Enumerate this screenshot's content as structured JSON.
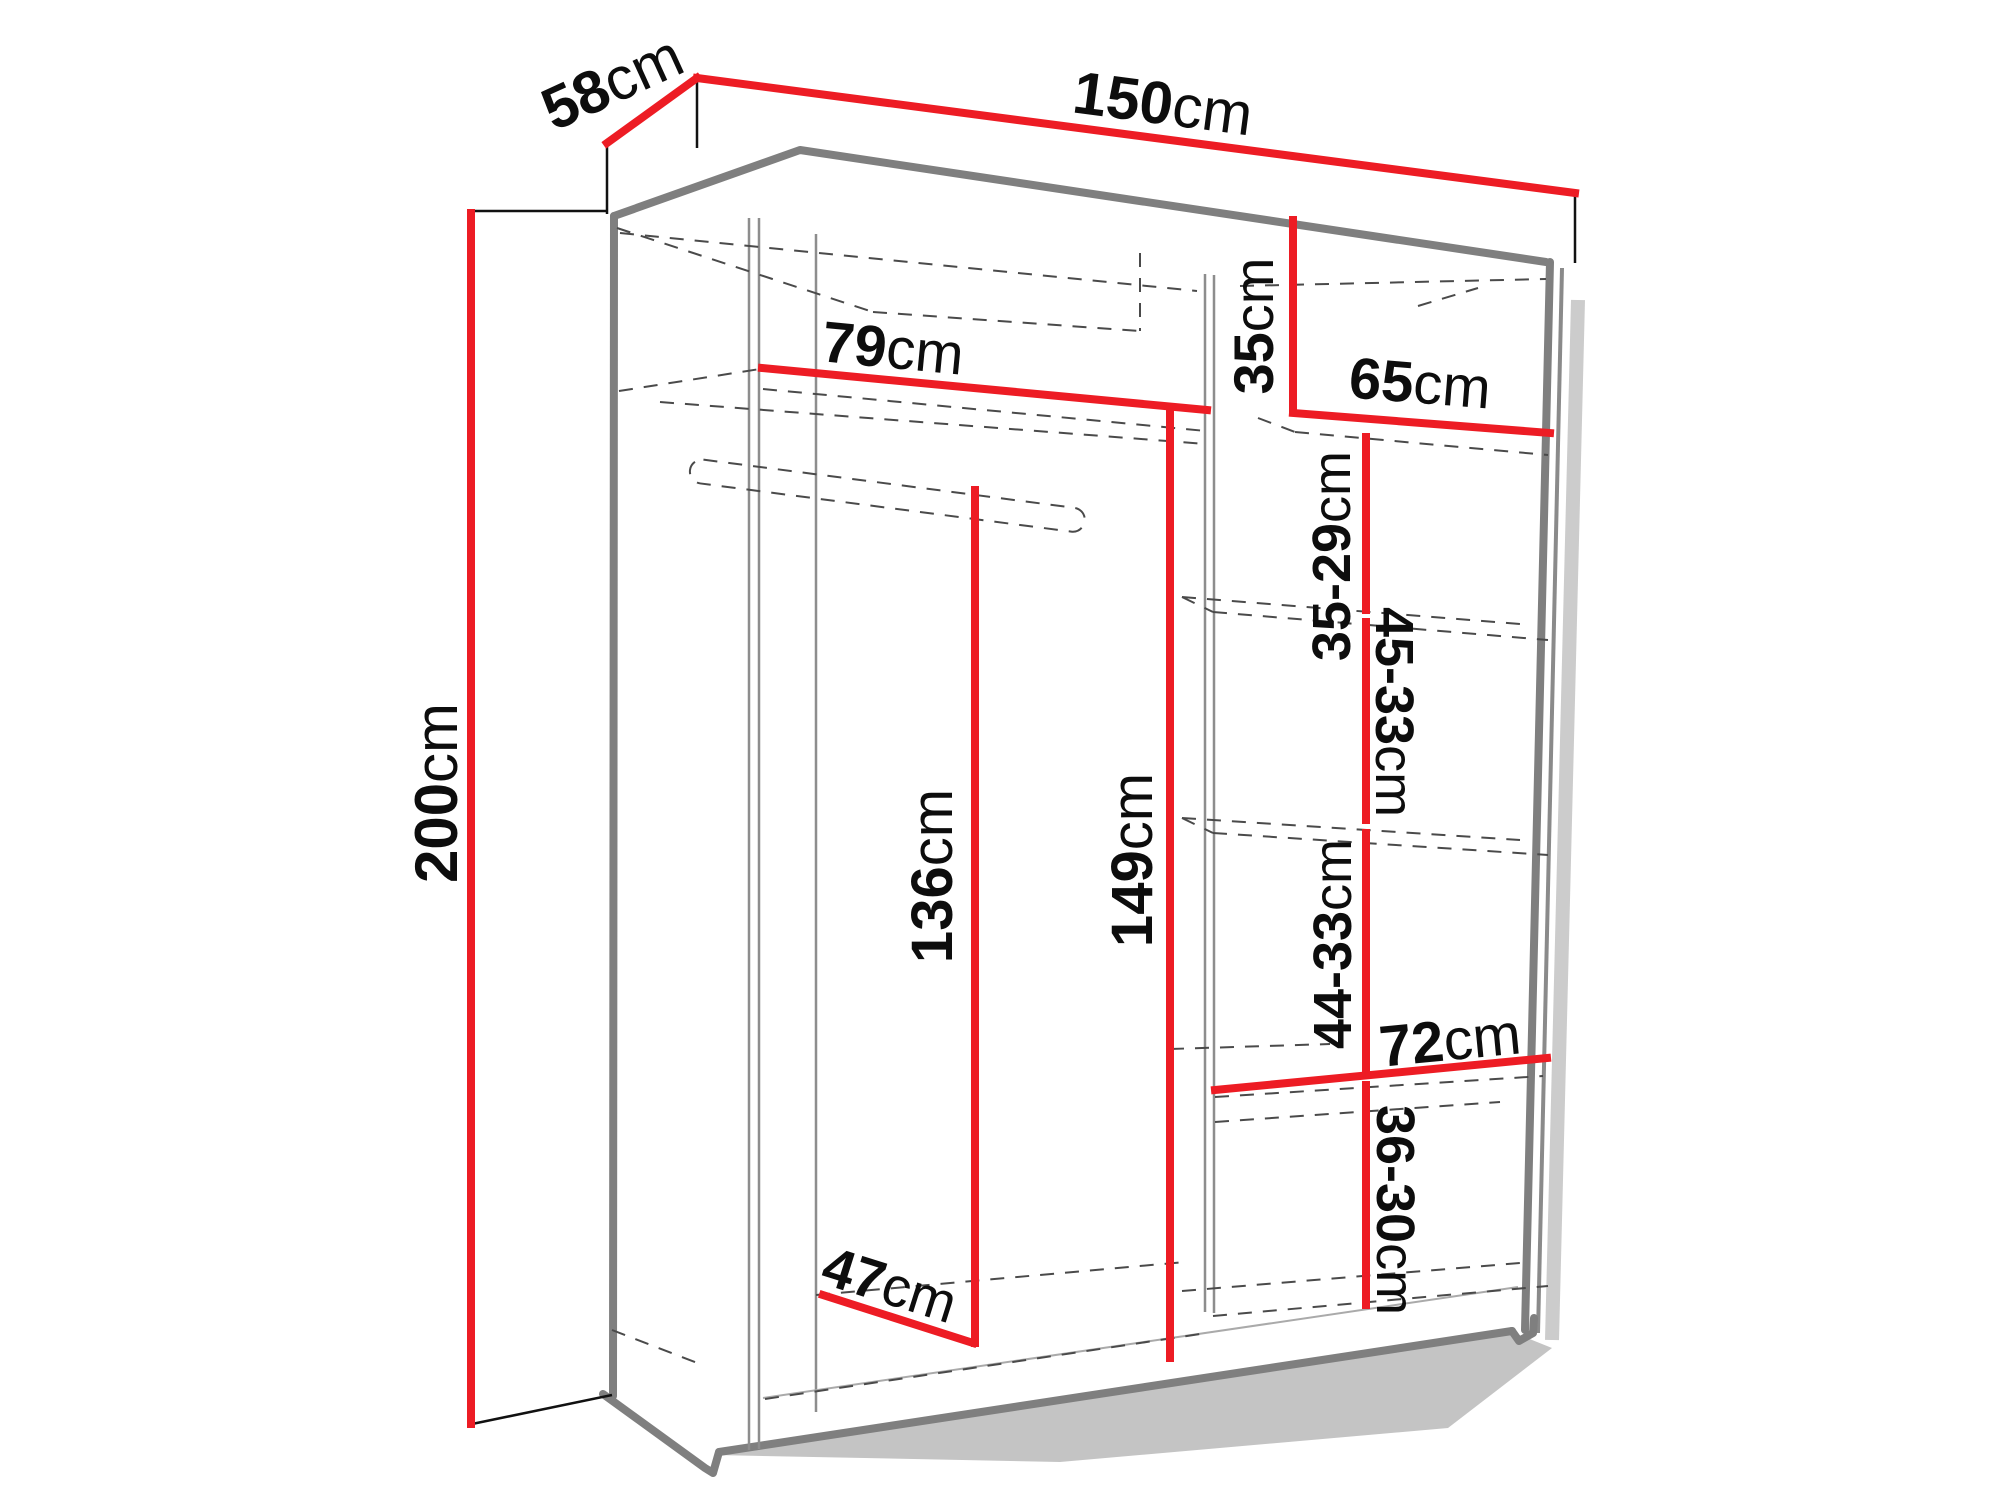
{
  "diagram": {
    "type": "wardrobe-dimension-diagram",
    "subject": "two-door sliding wardrobe with shelves and hanging rail, interior dimensions",
    "unit": "cm",
    "colors": {
      "dimension_line": "#ed1c24",
      "structure_gray": "#7f7f7f",
      "text": "#0d0d0d",
      "dashed_hidden_edges": "#4a4a4a",
      "background": "#ffffff"
    },
    "overall": {
      "width": "150cm",
      "depth": "58cm",
      "height": "200cm"
    },
    "dims": {
      "d150": {
        "value": "150",
        "unit": "cm"
      },
      "d58": {
        "value": "58",
        "unit": "cm"
      },
      "d200": {
        "value": "200",
        "unit": "cm"
      },
      "d79": {
        "value": "79",
        "unit": "cm"
      },
      "d35": {
        "value": "35",
        "unit": "cm"
      },
      "d65": {
        "value": "65",
        "unit": "cm"
      },
      "d35_29": {
        "value": "35-29",
        "unit": "cm"
      },
      "d45_33": {
        "value": "45-33",
        "unit": "cm"
      },
      "d44_33": {
        "value": "44-33",
        "unit": "cm"
      },
      "d36_30": {
        "value": "36-30",
        "unit": "cm"
      },
      "d136": {
        "value": "136",
        "unit": "cm"
      },
      "d149": {
        "value": "149",
        "unit": "cm"
      },
      "d72": {
        "value": "72",
        "unit": "cm"
      },
      "d47": {
        "value": "47",
        "unit": "cm"
      }
    }
  }
}
